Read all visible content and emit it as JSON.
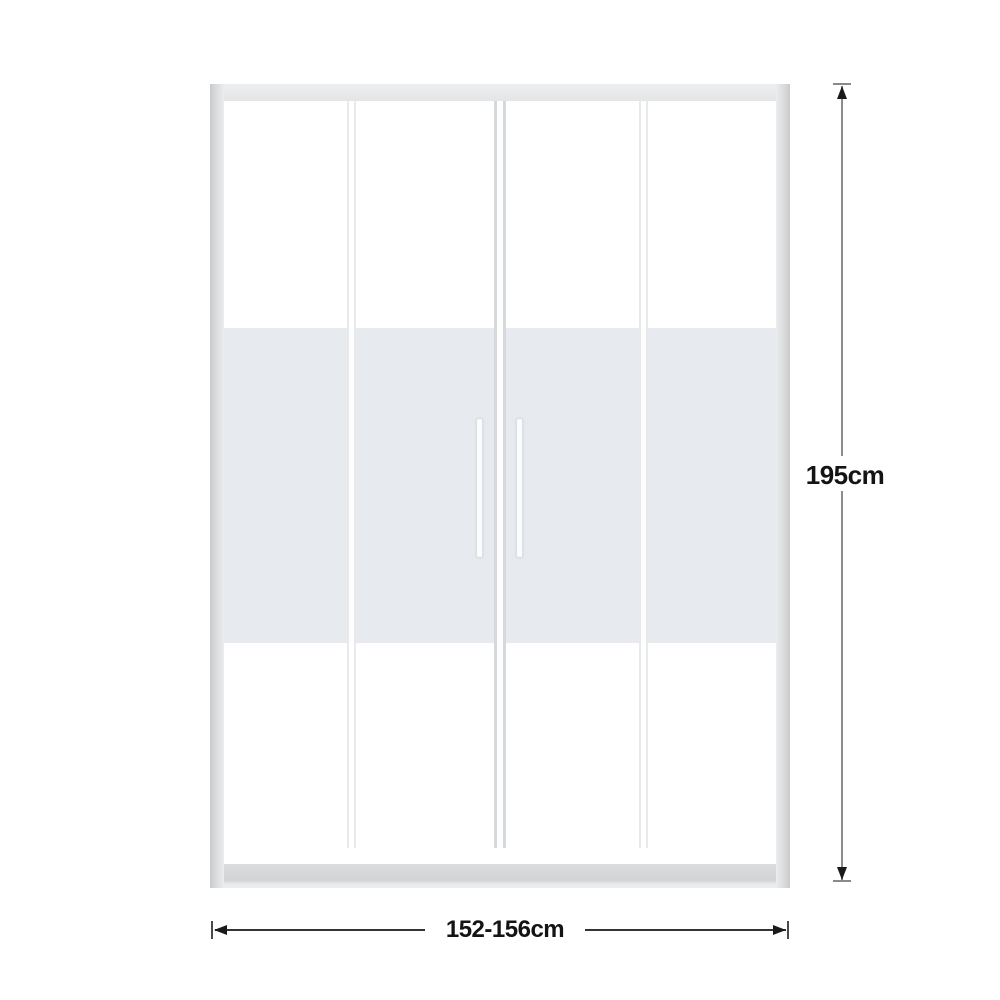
{
  "page": {
    "background_color": "#ffffff"
  },
  "diagram": {
    "kind": "product-dimension-diagram",
    "subject": "sliding shower door with four glass panels and frosted center band",
    "door": {
      "panel_count": 4,
      "handle_count": 2,
      "frame_color": "#dadcdd",
      "frame_edge_color": "#c9cbcc",
      "glass_clear_color": "#ffffff",
      "glass_frosted_color": "#e7eaee",
      "center_divider_color": "#d6d9db",
      "handle_color": "#fbfcfd"
    },
    "dimensions": {
      "height": {
        "label": "195cm"
      },
      "width": {
        "label": "152-156cm"
      },
      "line_color_vertical": "#8c8c8c",
      "line_color_horizontal": "#343434",
      "arrow_color": "#1a1a1a",
      "text_color": "#141414"
    }
  }
}
